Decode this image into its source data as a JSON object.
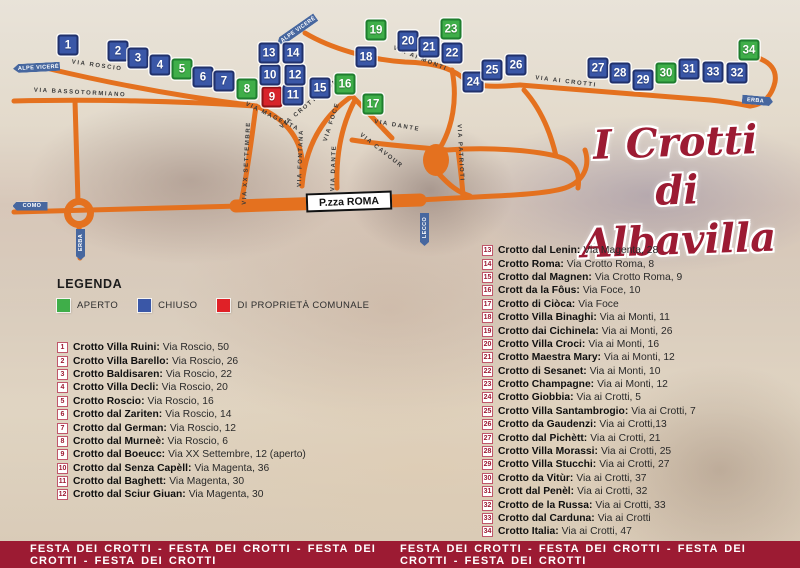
{
  "title": {
    "line1": "I Crotti",
    "line2": "di Albavilla"
  },
  "colors": {
    "accent_red": "#9c1b33",
    "road_orange": "#e4711f",
    "marker_open": "#3fae49",
    "marker_closed": "#3a57a7",
    "marker_municipal": "#d8232a"
  },
  "legend": {
    "heading": "LEGENDA",
    "items": [
      {
        "label": "APERTO",
        "color": "#3fae49"
      },
      {
        "label": "CHIUSO",
        "color": "#3a57a7"
      },
      {
        "label": "DI PROPRIETÀ COMUNALE",
        "color": "#e02127"
      }
    ]
  },
  "map": {
    "piazza_label": "P.zza ROMA",
    "road_labels": [
      {
        "text": "VIA ROSCIO",
        "x": 97,
        "y": 66,
        "r": 8
      },
      {
        "text": "VIA BASSOTORMIANO",
        "x": 80,
        "y": 93,
        "r": 3
      },
      {
        "text": "VIA MAGENTA",
        "x": 272,
        "y": 117,
        "r": 26
      },
      {
        "text": "VIA XX SETTEMBRE",
        "x": 247,
        "y": 163,
        "r": -87
      },
      {
        "text": "VIA CROTTO ROMA",
        "x": 312,
        "y": 102,
        "r": -40
      },
      {
        "text": "VIA FOCE",
        "x": 332,
        "y": 122,
        "r": -72
      },
      {
        "text": "VIA FONTANA",
        "x": 301,
        "y": 158,
        "r": -88
      },
      {
        "text": "VIA DANTE",
        "x": 334,
        "y": 168,
        "r": -88
      },
      {
        "text": "VIA DANTE",
        "x": 397,
        "y": 126,
        "r": 10
      },
      {
        "text": "VIA CAVOUR",
        "x": 381,
        "y": 151,
        "r": 38
      },
      {
        "text": "VIA PATRIOTI",
        "x": 460,
        "y": 153,
        "r": 87
      },
      {
        "text": "VIA AI MONTI",
        "x": 420,
        "y": 59,
        "r": 22
      },
      {
        "text": "VIA AI CROTTI",
        "x": 566,
        "y": 82,
        "r": 7
      }
    ],
    "signs": [
      {
        "text": "ALPE VICERÉ",
        "x": 36,
        "y": 67,
        "w": 47,
        "h": 9,
        "dir": "left",
        "r": -3
      },
      {
        "text": "ALPE VICERÉ",
        "x": 296,
        "y": 30,
        "w": 47,
        "h": 9,
        "dir": "left",
        "r": -35
      },
      {
        "text": "COMO",
        "x": 30,
        "y": 206,
        "w": 35,
        "h": 9,
        "dir": "left",
        "r": 0
      },
      {
        "text": "ERBA",
        "x": 80,
        "y": 244,
        "w": 31,
        "h": 9,
        "dir": "left",
        "r": -90
      },
      {
        "text": "LECCO",
        "x": 424,
        "y": 229,
        "w": 33,
        "h": 9,
        "dir": "left",
        "r": -90
      },
      {
        "text": "ERBA",
        "x": 757,
        "y": 100,
        "w": 31,
        "h": 9,
        "dir": "right",
        "r": 5
      }
    ],
    "markers": [
      {
        "n": 1,
        "x": 68,
        "y": 45,
        "status": "chiuso"
      },
      {
        "n": 2,
        "x": 118,
        "y": 51,
        "status": "chiuso"
      },
      {
        "n": 3,
        "x": 138,
        "y": 58,
        "status": "chiuso"
      },
      {
        "n": 4,
        "x": 160,
        "y": 65,
        "status": "chiuso"
      },
      {
        "n": 5,
        "x": 182,
        "y": 69,
        "status": "aperto"
      },
      {
        "n": 6,
        "x": 203,
        "y": 77,
        "status": "chiuso"
      },
      {
        "n": 7,
        "x": 224,
        "y": 81,
        "status": "chiuso"
      },
      {
        "n": 8,
        "x": 247,
        "y": 89,
        "status": "aperto"
      },
      {
        "n": 9,
        "x": 272,
        "y": 97,
        "status": "comunale"
      },
      {
        "n": 10,
        "x": 270,
        "y": 75,
        "status": "chiuso"
      },
      {
        "n": 11,
        "x": 293,
        "y": 95,
        "status": "chiuso"
      },
      {
        "n": 12,
        "x": 295,
        "y": 75,
        "status": "chiuso"
      },
      {
        "n": 13,
        "x": 269,
        "y": 53,
        "status": "chiuso"
      },
      {
        "n": 14,
        "x": 293,
        "y": 53,
        "status": "chiuso"
      },
      {
        "n": 15,
        "x": 320,
        "y": 88,
        "status": "chiuso"
      },
      {
        "n": 16,
        "x": 345,
        "y": 84,
        "status": "aperto"
      },
      {
        "n": 17,
        "x": 373,
        "y": 104,
        "status": "aperto"
      },
      {
        "n": 18,
        "x": 366,
        "y": 57,
        "status": "chiuso"
      },
      {
        "n": 19,
        "x": 376,
        "y": 30,
        "status": "aperto"
      },
      {
        "n": 20,
        "x": 408,
        "y": 41,
        "status": "chiuso"
      },
      {
        "n": 21,
        "x": 429,
        "y": 47,
        "status": "chiuso"
      },
      {
        "n": 22,
        "x": 452,
        "y": 53,
        "status": "chiuso"
      },
      {
        "n": 23,
        "x": 451,
        "y": 29,
        "status": "aperto"
      },
      {
        "n": 24,
        "x": 473,
        "y": 82,
        "status": "chiuso"
      },
      {
        "n": 25,
        "x": 492,
        "y": 70,
        "status": "chiuso"
      },
      {
        "n": 26,
        "x": 516,
        "y": 65,
        "status": "chiuso"
      },
      {
        "n": 27,
        "x": 598,
        "y": 68,
        "status": "chiuso"
      },
      {
        "n": 28,
        "x": 620,
        "y": 73,
        "status": "chiuso"
      },
      {
        "n": 29,
        "x": 643,
        "y": 80,
        "status": "chiuso"
      },
      {
        "n": 30,
        "x": 666,
        "y": 73,
        "status": "aperto"
      },
      {
        "n": 31,
        "x": 689,
        "y": 69,
        "status": "chiuso"
      },
      {
        "n": 32,
        "x": 737,
        "y": 73,
        "status": "chiuso"
      },
      {
        "n": 33,
        "x": 713,
        "y": 72,
        "status": "chiuso"
      },
      {
        "n": 34,
        "x": 749,
        "y": 50,
        "status": "aperto"
      }
    ]
  },
  "list_left": [
    {
      "n": 1,
      "name": "Crotto Villa Ruini:",
      "addr": "Via Roscio, 50"
    },
    {
      "n": 2,
      "name": "Crotto Villa Barello:",
      "addr": "Via Roscio, 26"
    },
    {
      "n": 3,
      "name": "Crotto Baldisaren:",
      "addr": "Via Roscio, 22"
    },
    {
      "n": 4,
      "name": "Crotto Villa Decli:",
      "addr": "Via Roscio, 20"
    },
    {
      "n": 5,
      "name": "Crotto Roscio:",
      "addr": "Via Roscio, 16"
    },
    {
      "n": 6,
      "name": "Crotto dal Zariten:",
      "addr": "Via Roscio, 14"
    },
    {
      "n": 7,
      "name": "Crotto dal German:",
      "addr": "Via Roscio, 12"
    },
    {
      "n": 8,
      "name": "Crotto dal Murneè:",
      "addr": "Via Roscio, 6"
    },
    {
      "n": 9,
      "name": "Crotto dal Boeucc:",
      "addr": "Via XX Settembre, 12 (aperto)"
    },
    {
      "n": 10,
      "name": "Crotto dal Senza Capèll:",
      "addr": "Via Magenta, 36"
    },
    {
      "n": 11,
      "name": "Crotto dal Baghett:",
      "addr": "Via Magenta, 30"
    },
    {
      "n": 12,
      "name": "Crotto dal Sciur Giuan:",
      "addr": "Via Magenta, 30"
    }
  ],
  "list_right": [
    {
      "n": 13,
      "name": "Crotto dal Lenin:",
      "addr": "Via Magenta, 28"
    },
    {
      "n": 14,
      "name": "Crotto Roma:",
      "addr": "Via Crotto Roma, 8"
    },
    {
      "n": 15,
      "name": "Crotto dal Magnen:",
      "addr": "Via Crotto Roma, 9"
    },
    {
      "n": 16,
      "name": "Crott da la Fôus:",
      "addr": "Via Foce, 10"
    },
    {
      "n": 17,
      "name": "Crotto di Ciòca:",
      "addr": "Via Foce"
    },
    {
      "n": 18,
      "name": "Crotto Villa Binaghi:",
      "addr": "Via ai Monti, 11"
    },
    {
      "n": 19,
      "name": "Crotto dai Cichinela:",
      "addr": "Via ai Monti, 26"
    },
    {
      "n": 20,
      "name": "Crotto Villa Croci:",
      "addr": "Via ai Monti, 16"
    },
    {
      "n": 21,
      "name": "Crotto Maestra Mary:",
      "addr": "Via ai Monti, 12"
    },
    {
      "n": 22,
      "name": "Crotto di Sesanet:",
      "addr": "Via ai Monti, 10"
    },
    {
      "n": 23,
      "name": "Crotto Champagne:",
      "addr": "Via ai Monti, 12"
    },
    {
      "n": 24,
      "name": "Crotto Giobbia:",
      "addr": "Via ai Crotti, 5"
    },
    {
      "n": 25,
      "name": "Crotto Villa Santambrogio:",
      "addr": "Via ai Crotti, 7"
    },
    {
      "n": 26,
      "name": "Crotto da Gaudenzi:",
      "addr": "Via ai Crotti,13"
    },
    {
      "n": 27,
      "name": "Crotto dal Pichètt:",
      "addr": "Via ai Crotti, 21"
    },
    {
      "n": 28,
      "name": "Crotto Villa Morassi:",
      "addr": "Via ai Crotti, 25"
    },
    {
      "n": 29,
      "name": "Crotto Villa Stucchi:",
      "addr": "Via ai Crotti, 27"
    },
    {
      "n": 30,
      "name": "Crotto da Vitùr:",
      "addr": "Via ai Crotti, 37"
    },
    {
      "n": 31,
      "name": "Crott dal Penèl:",
      "addr": "Via ai Crotti, 32"
    },
    {
      "n": 32,
      "name": "Crotto de la Russa:",
      "addr": "Via ai Crotti, 33"
    },
    {
      "n": 33,
      "name": "Crotto dal Carduna:",
      "addr": "Via ai Crotti"
    },
    {
      "n": 34,
      "name": "Crotto Italia:",
      "addr": "Via ai Crotti, 47"
    }
  ],
  "footer": {
    "left": "FESTA DEI CROTTI - FESTA DEI CROTTI - FESTA DEI CROTTI - FESTA DEI CROTTI",
    "right": "FESTA DEI CROTTI - FESTA DEI CROTTI - FESTA DEI CROTTI - FESTA DEI CROTTI"
  }
}
